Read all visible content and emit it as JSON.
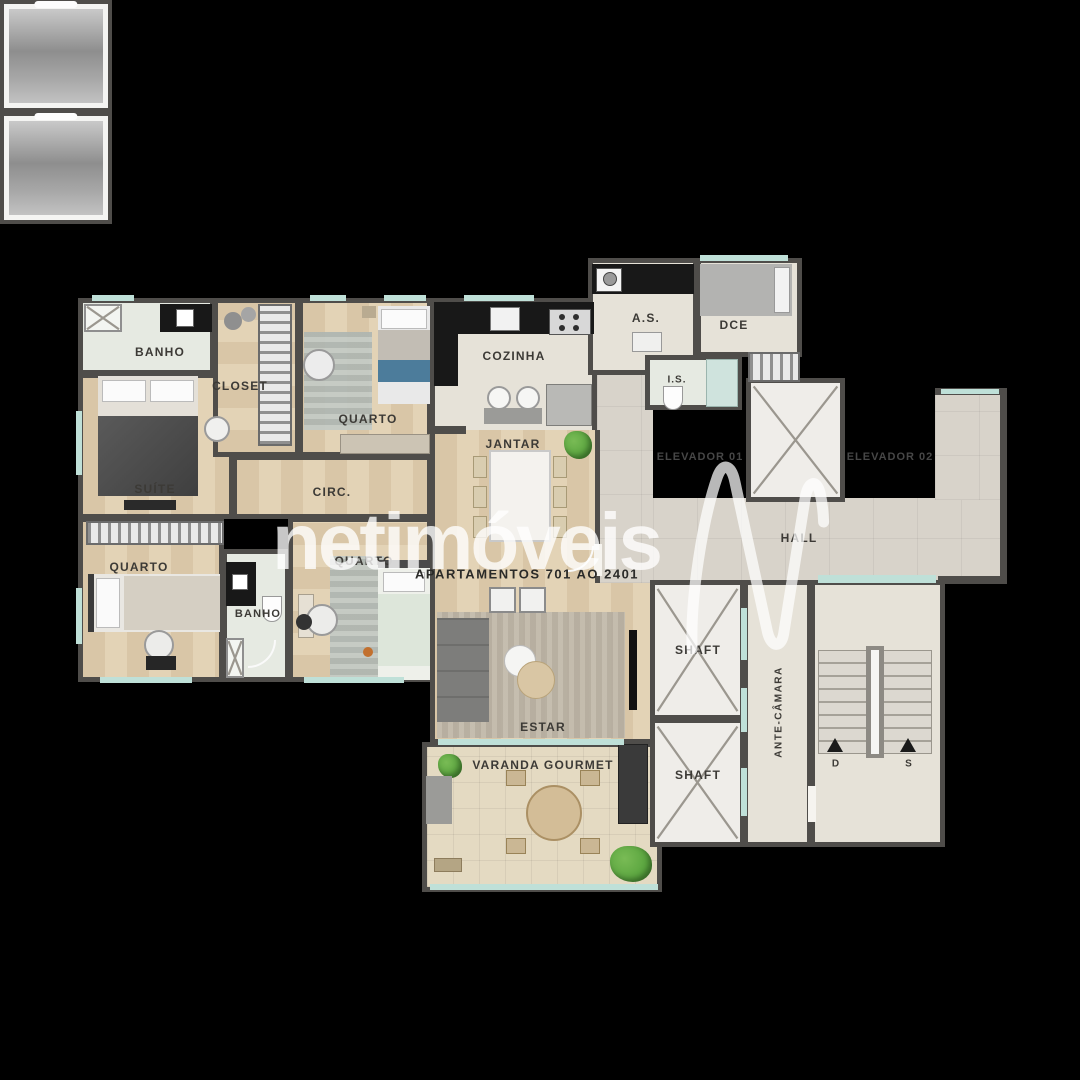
{
  "brand": {
    "watermark": "netimóveis",
    "logo_letter": "N"
  },
  "floor_plan": {
    "title": "APARTAMENTOS 701 AO 2401",
    "rooms": {
      "banho_suite": "BANHO",
      "closet": "CLOSET",
      "quarto_1": "QUARTO",
      "suite": "SUÍTE",
      "circ": "CIRC.",
      "quarto_2": "QUARTO",
      "banho_2": "BANHO",
      "quarto_3": "QUARTO",
      "cozinha": "COZINHA",
      "jantar": "JANTAR",
      "estar": "ESTAR",
      "varanda_gourmet": "VARANDA GOURMET",
      "area_servico": "A.S.",
      "dce": "DCE",
      "instalacao_sanitaria": "I.S.",
      "elevador_1": "ELEVADOR 01",
      "elevador_2": "ELEVADOR 02",
      "hall": "HALL",
      "shaft_1": "SHAFT",
      "shaft_2": "SHAFT",
      "ante_camara": "ANTE-CÂMARA"
    },
    "stairs": {
      "descend": "D",
      "ascend": "S"
    }
  },
  "colors": {
    "background": "#000000",
    "wall": "#4f4d4a",
    "wood": "#d9c6a7",
    "wood2": "#e3d3b6",
    "tile": "#e6eae2",
    "floorlight": "#e6e2d8",
    "hall": "#d8d3ca",
    "varanda": "#e4dac2",
    "teal": "#bfe0d8",
    "counter": "#181818",
    "green": "#56a23c",
    "bedblue": "#4c7c9b",
    "label": "#3c3a36"
  }
}
